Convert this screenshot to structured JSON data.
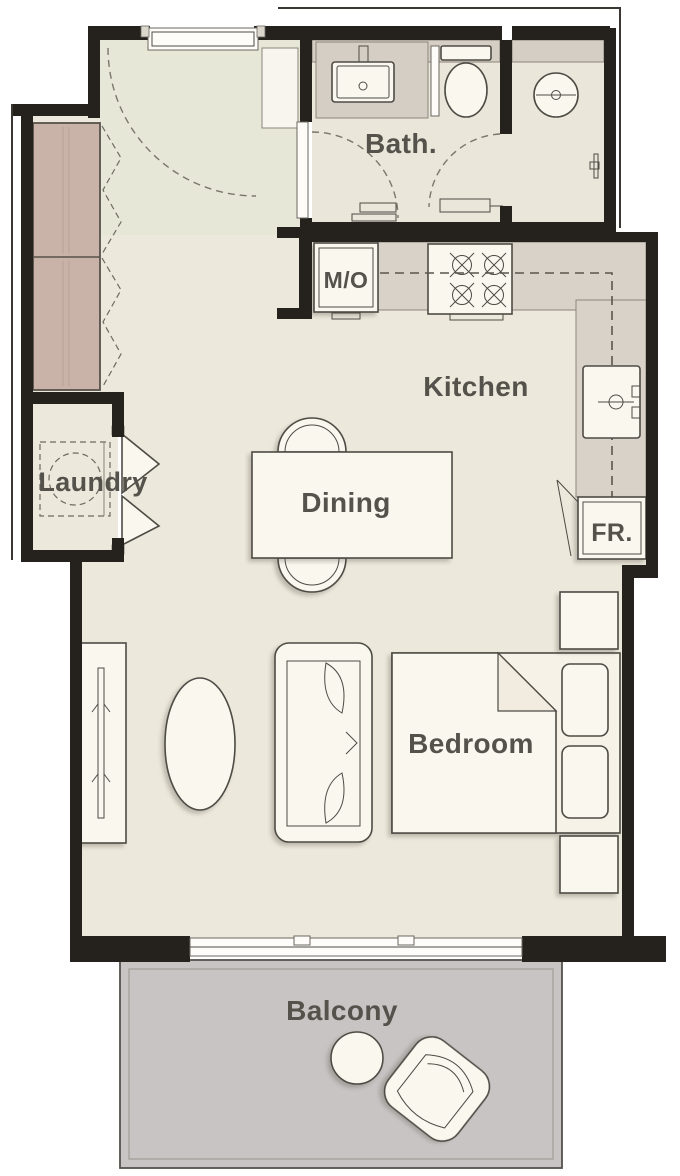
{
  "plan": {
    "type": "apartment-floor-plan"
  },
  "labels": {
    "bath": "Bath.",
    "kitchen": "Kitchen",
    "microwave": "M/O",
    "laundry": "Laundry",
    "dining": "Dining",
    "fridge": "FR.",
    "bedroom": "Bedroom",
    "balcony": "Balcony"
  },
  "colors": {
    "background": "#ffffff",
    "floor": "#ece8db",
    "entry_tint": "#e3e6d2",
    "bath_floor": "#eae6da",
    "tile": "#d5cec4",
    "counter": "#d9d2c8",
    "wardrobe": "#c9b2a8",
    "balcony_floor": "#c8c4c3",
    "wall": "#25221e",
    "furniture_fill": "#faf7ef",
    "line": "#4e4b45",
    "label_text": "#55524c"
  }
}
